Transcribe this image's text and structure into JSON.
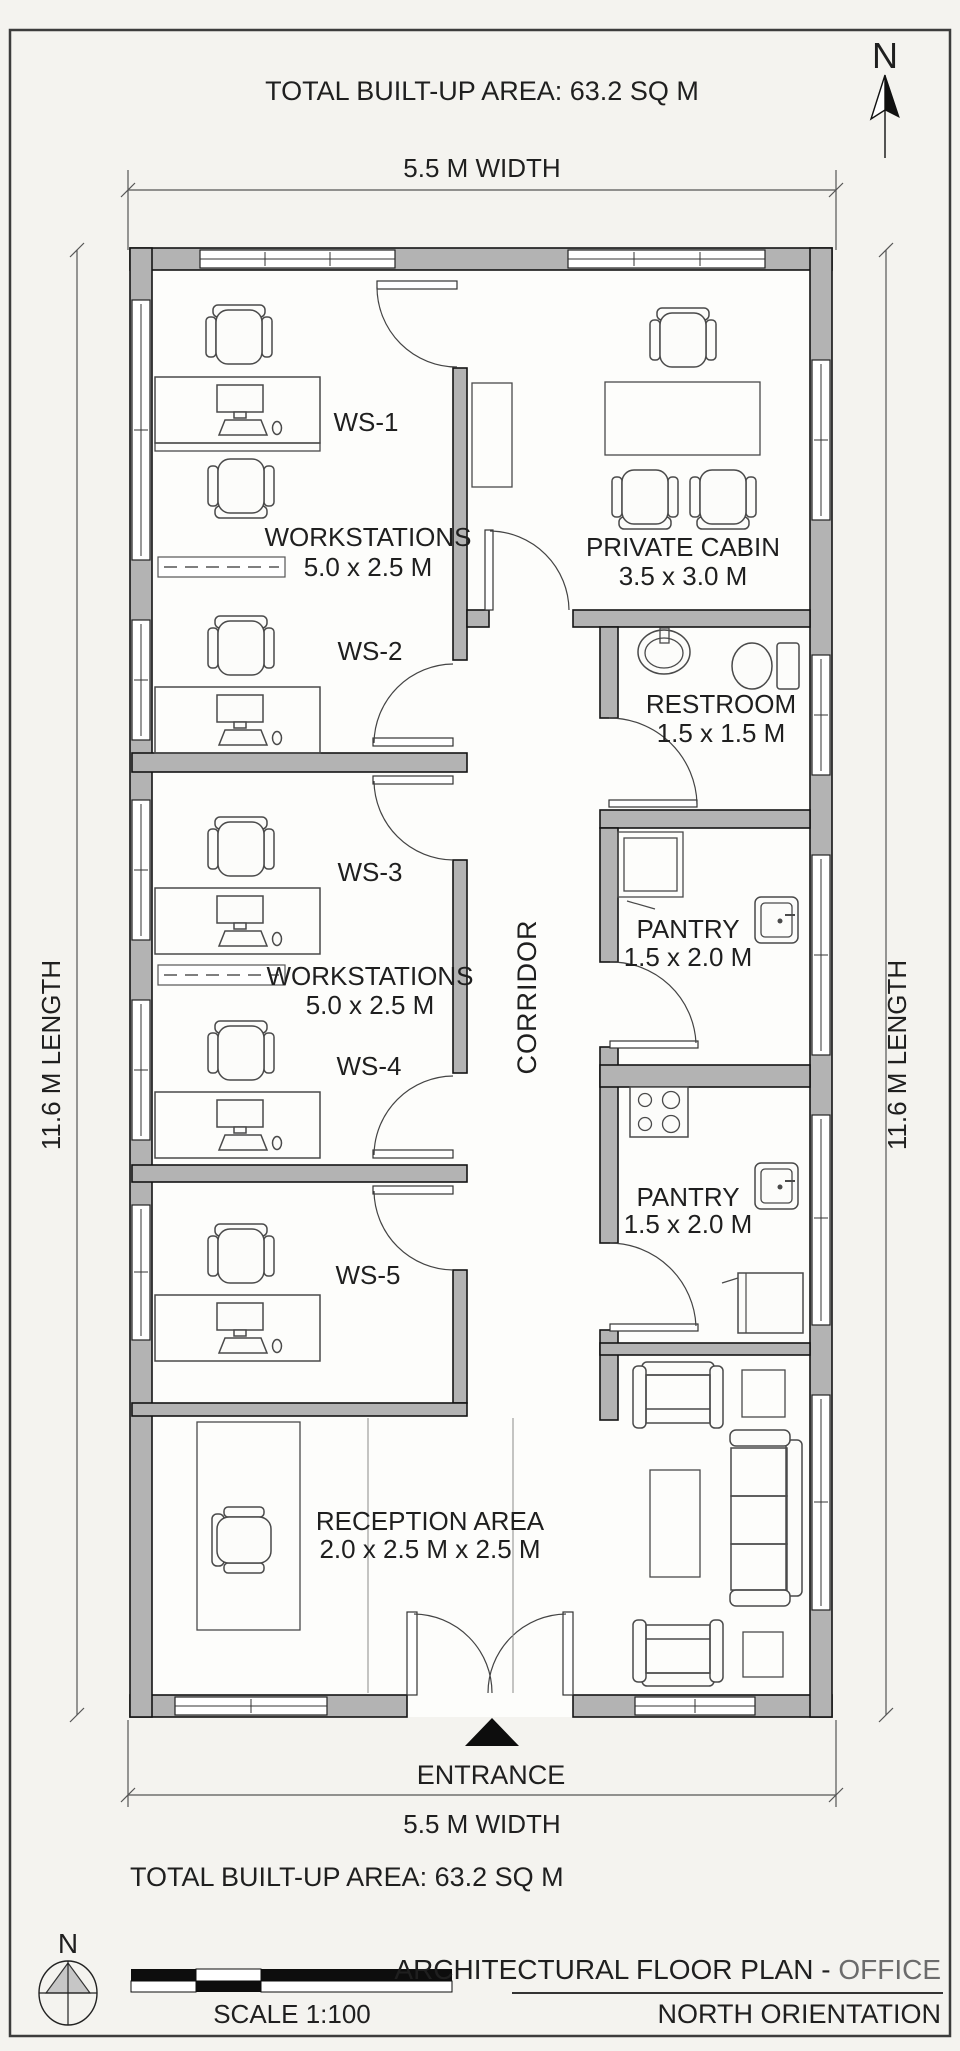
{
  "header": {
    "total_area": "TOTAL BUILT-UP AREA: 63.2 SQ M",
    "north_letter": "N",
    "width_dim": "5.5 M WIDTH"
  },
  "plan": {
    "ws": [
      "WS-1",
      "WS-2",
      "WS-3",
      "WS-4",
      "WS-5"
    ],
    "workstations_upper": {
      "name": "WORKSTATIONS",
      "dim": "5.0 x 2.5 M"
    },
    "workstations_lower": {
      "name": "WORKSTATIONS",
      "dim": "5.0 x 2.5 M"
    },
    "private_cabin": {
      "name": "PRIVATE CABIN",
      "dim": "3.5 x 3.0 M"
    },
    "restroom": {
      "name": "RESTROOM",
      "dim": "1.5 x 1.5 M"
    },
    "pantry_upper": {
      "name": "PANTRY",
      "dim": "1.5 x 2.0 M"
    },
    "pantry_lower": {
      "name": "PANTRY",
      "dim": "1.5 x 2.0 M"
    },
    "corridor": "CORRIDOR",
    "reception": {
      "name": "RECEPTION AREA",
      "dim": "2.0 x 2.5 M x 2.5 M"
    },
    "entrance": "ENTRANCE",
    "length_dim_left": "11.6 M LENGTH",
    "length_dim_right": "11.6 M LENGTH"
  },
  "footer": {
    "width_dim": "5.5 M WIDTH",
    "total_area": "TOTAL BUILT-UP AREA: 63.2 SQ M",
    "compass_letter": "N",
    "scale_label": "SCALE 1:100",
    "title_main": "ARCHITECTURAL FLOOR PLAN - ",
    "title_highlight": "OFFICE",
    "subtitle": "NORTH ORIENTATION"
  },
  "colors": {
    "wall_fill": "#b3b3b3",
    "ink": "#1f1f1f",
    "paper": "#f4f3ef"
  }
}
